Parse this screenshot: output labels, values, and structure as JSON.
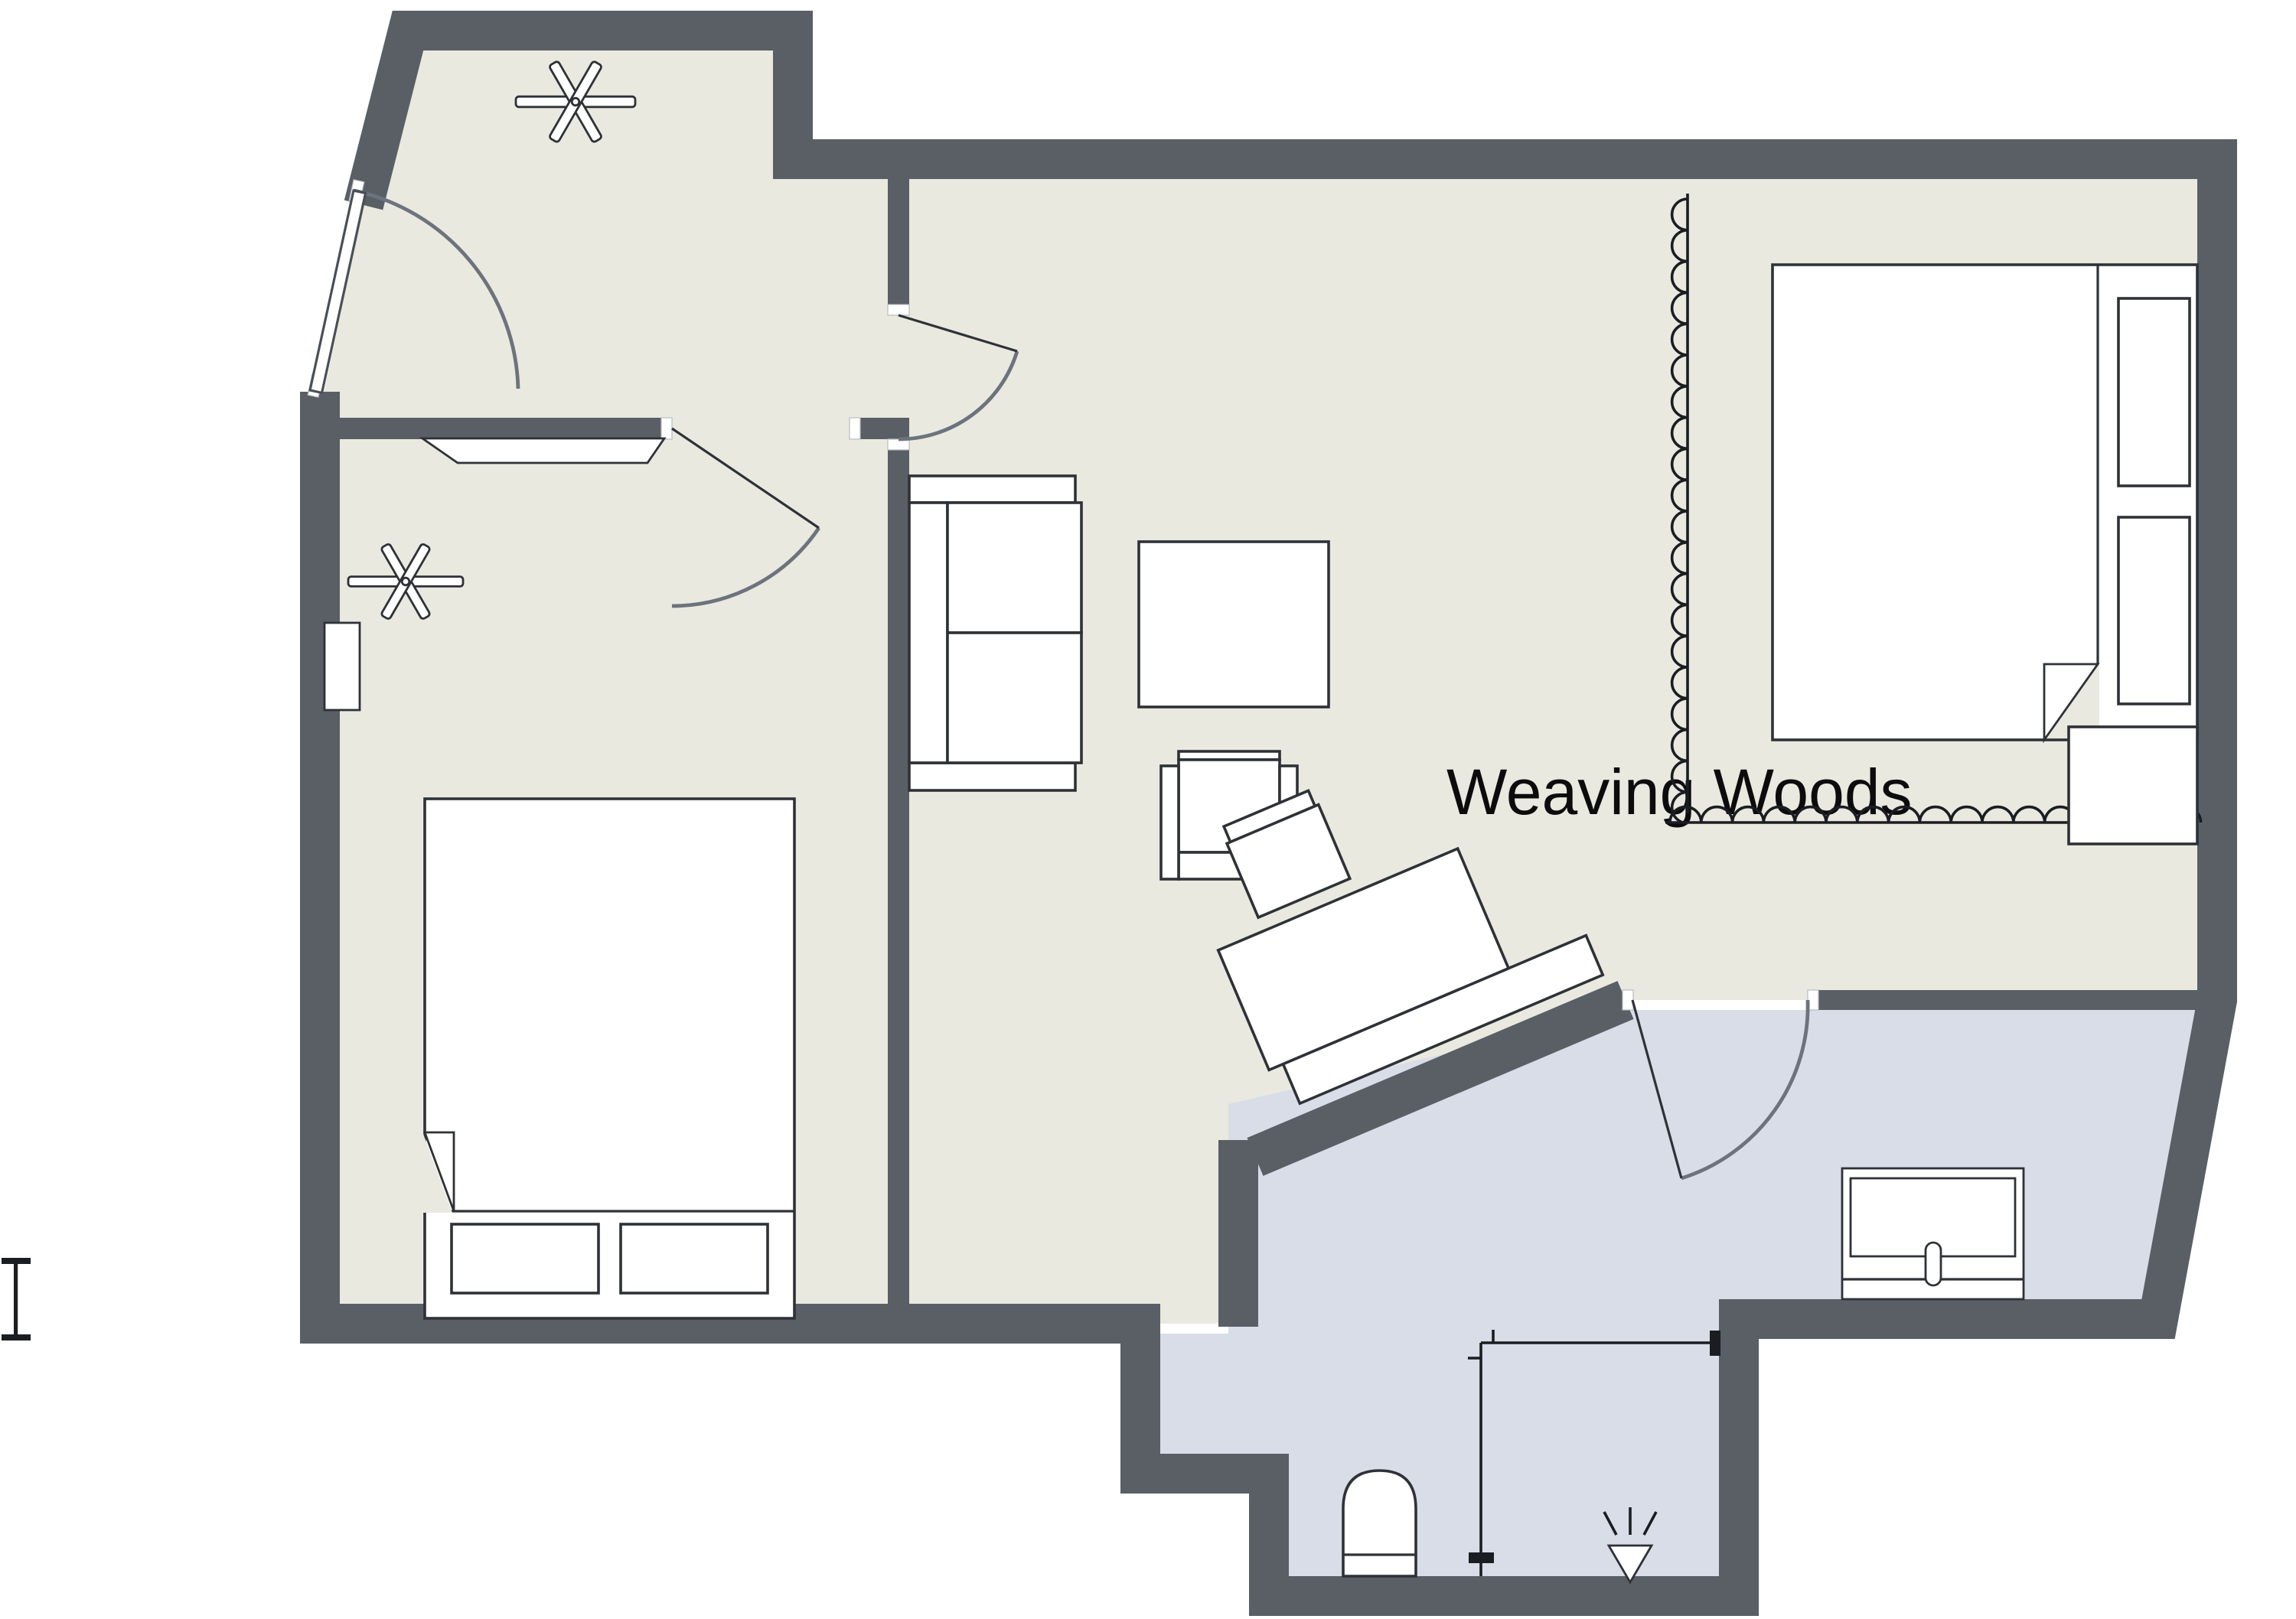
{
  "app": {
    "type": "floor-plan-viewer"
  },
  "title": {
    "label": "Weaving Woods"
  },
  "colors": {
    "wall": "#5a5f66",
    "floor_main": "#e9e9e0",
    "floor_wet": "#d9dde8",
    "furniture_fill": "#ffffff",
    "furniture_stroke": "#2e3237",
    "door_arc": "#6d737c",
    "symbol_stroke": "#1a1d21",
    "background": "#ffffff"
  },
  "rooms": [
    {
      "name": "entry-hall"
    },
    {
      "name": "bedroom-left"
    },
    {
      "name": "living-room"
    },
    {
      "name": "sleeping-area-right"
    },
    {
      "name": "bathroom-wet-area"
    }
  ],
  "furniture": [
    "double-bed-left",
    "double-bed-right",
    "sofa",
    "coffee-table",
    "armchair",
    "desk",
    "desk-chair",
    "console-table",
    "dresser",
    "nightstand",
    "toilet",
    "shower",
    "curtain-divider",
    "window-shelf"
  ],
  "icons": [
    "ceiling-fan-icon",
    "shower-head-icon",
    "toilet-icon",
    "door-swing-icon",
    "section-marker-icon"
  ]
}
